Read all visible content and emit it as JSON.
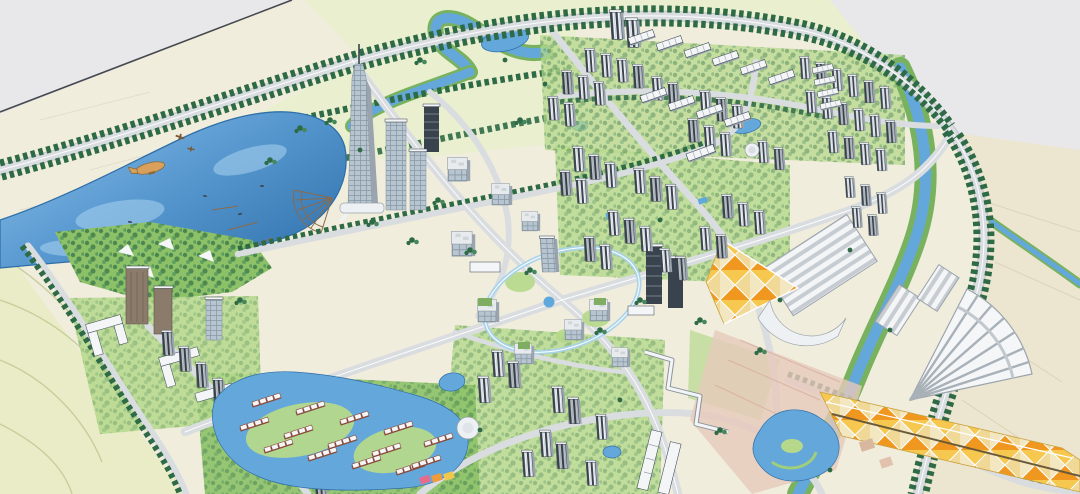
{
  "meta": {
    "description": "Aerial 3D rendering of a lakeside urban master plan with a landmark tower, residential tower clusters, villa lagoons, greenway rivers and orange-roofed commercial halls",
    "aria_label": "Bird's-eye architectural rendering of a planned lakeside city district"
  },
  "colors": {
    "base_cream": "#f1eddd",
    "offplan_gray": "#e8e8ea",
    "offplan_green": "#e9efcf",
    "offplan_beige": "#ece5cf",
    "farmland": "#e9ecc6",
    "farmland_line": "#c6cf9b",
    "river": "#64a7da",
    "water_rim": "#2f6fa8",
    "pool_blue": "#5fa8dc",
    "bank_green": "#79b25f",
    "lawn": "#b5d88b",
    "park": "#8cc168",
    "tree_dark": "#2d6a45",
    "tree_lite": "#44885c",
    "road": "#dadde0",
    "road_edge": "#bfc4c9",
    "road_line": "#fbfcfd",
    "bldg_white": "#f3f5f7",
    "bldg_shade": "#9aa4ae",
    "facade_dark": "#39434e",
    "glass": "#b6c5d0",
    "glass_line": "#7e8d99",
    "office_light": "#e8ebed",
    "office_line": "#9aa4ad",
    "brown_bldg": "#8b7b6a",
    "roof_green": "#7fae62",
    "orange": "#f0971f",
    "yellow": "#f6c84f",
    "cream_roof": "#f3e7c2",
    "plaza_pink": "#e7c9bc",
    "villa_trim": "#8a4a3c",
    "ring_blue": "#a9d3ea",
    "rail": "#45484d",
    "blimp": "#d9a05c",
    "lake_1": "#8fc2e8",
    "lake_2": "#5b9bd2",
    "lake_3": "#3d7eb8"
  },
  "scene": {
    "elements": [
      "lake",
      "landmark-tower",
      "marina-fan-pier",
      "central-ring-skybridge",
      "residential-tower-clusters",
      "villa-lagoon",
      "ribbed-exhibition-hall",
      "fan-roof-hall",
      "orange-diamond-mall-roof",
      "greenway-rivers",
      "airship",
      "biplanes",
      "farmland",
      "boundary-tree-roads",
      "campus-courtyards"
    ]
  }
}
